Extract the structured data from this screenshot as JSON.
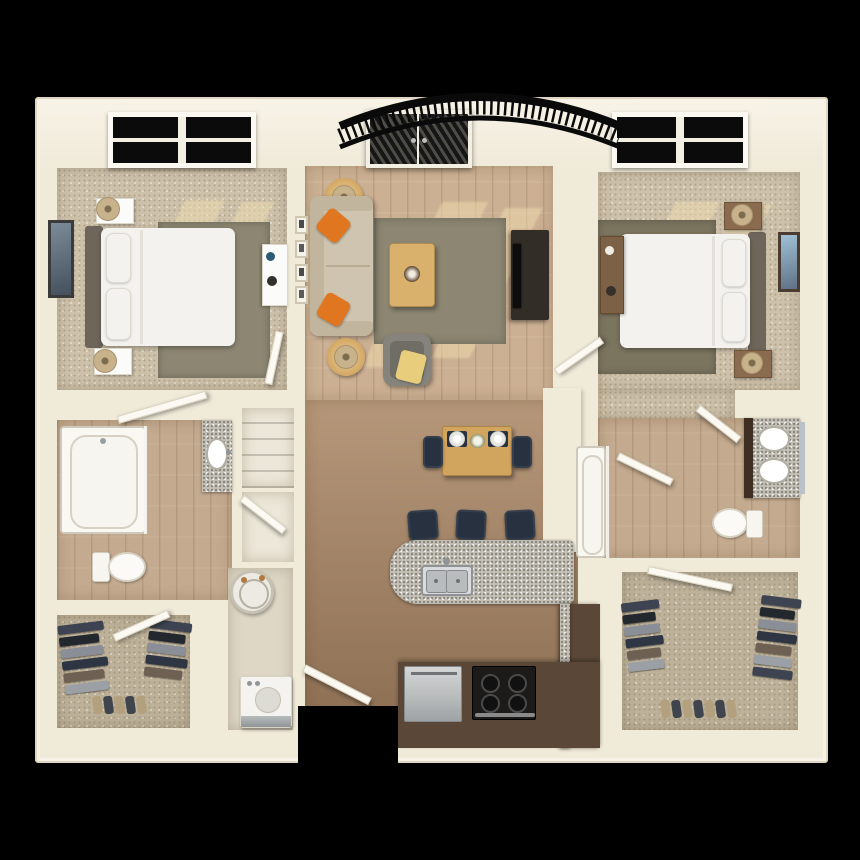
{
  "image": {
    "type": "3d-floor-plan",
    "description": "Top-down 3D rendered floor plan of a two-bedroom, two-bathroom apartment with living room, open kitchen and dining area, laundry room, two walk-in closets and an arched balcony railing at the top. No text labels are rendered.",
    "width_px": 860,
    "height_px": 860,
    "background": "#000000"
  },
  "summary": {
    "bedrooms": 2,
    "bathrooms": 2,
    "walk_in_closets": 2,
    "balcony": "arched black wrought-iron railing behind french doors",
    "entry": "open white entry door at bottom center"
  },
  "palette": {
    "bg": "#000000",
    "wall": "#f0ead9",
    "wallHi": "#f8f3e7",
    "carpet": "#cdc1aa",
    "carpetDark": "#bdb199",
    "woodTop": "#ccb093",
    "woodMid": "#b6977a",
    "woodBottom": "#8a6c51",
    "bathWood": "#c4aa8e",
    "rugOlive": "#8c8672",
    "rugDark": "#7b745f",
    "sofa": "#cfc4af",
    "sofaDark": "#c2b59e",
    "orange": "#e0761f",
    "tableWood": "#d2a55f",
    "coffee": "#d9b06c",
    "tvDark": "#332d28",
    "screen": "#0d0d0d",
    "chairGray": "#85837c",
    "chairGrayDark": "#6f6d64",
    "throwYellow": "#e7cd7c",
    "navy": "#27313f",
    "granite": "#c2beb4",
    "cabinetBrown": "#5a4737",
    "stainless": "#b9bcbd",
    "rangeBlack": "#1d1b19",
    "bedWhite": "#f3f2ee",
    "headboard": "#6e665b",
    "nightWhite": "#fbfbf9",
    "woodBrown": "#8a6b4f",
    "lampTan": "#c7b28c",
    "lampRing": "#a8946e",
    "artBlue": "#5f7186",
    "glassDark": "#0b0b0b",
    "doorWhite": "#fbf9f2",
    "doorEdge": "#d8d2c0",
    "sun": "#f0ddb0",
    "shadowOlive": "#8d8568",
    "fixtureBorder": "#cfc9bb",
    "tubWhite": "#f6f5f0",
    "linenFloor": "#ece7d8",
    "laundryFloor": "#ded7c5",
    "heaterWhite": "#eceae3",
    "copper": "#b0793f",
    "shoeTan": "#b3a07e",
    "shoeDark": "#3f444d",
    "garment1": "#3d4350",
    "garment2": "#23272e",
    "garment3": "#8a8e96",
    "garment4": "#2e3644",
    "garment5": "#6e6154",
    "garment6": "#9aa0a6",
    "railing": "#0a0a0a",
    "mirror": "#b9c2c6"
  },
  "rooms": [
    {
      "id": "bedroom-1",
      "position": "top-left",
      "floor": "carpet",
      "features": [
        "four-pane window",
        "sunlight patches on carpet"
      ],
      "furniture": [
        "double bed with dark headboard on left wall",
        "two white nightstands with tan table lamps",
        "dark olive area rug",
        "framed wall art on left wall",
        "small white desk on right wall"
      ]
    },
    {
      "id": "living-room",
      "position": "top-center",
      "floor": "hardwood",
      "features": [
        "french doors with dark glass to balcony",
        "arched black balcony railing",
        "four small gallery frames on left wall",
        "sunlight patches"
      ],
      "furniture": [
        "beige sofa with two orange accent pillows",
        "two round wood end tables with lamps",
        "wood coffee table with decor",
        "olive area rug",
        "dark media console with flat tv",
        "gray armchair with yellow throw"
      ]
    },
    {
      "id": "bedroom-2",
      "position": "top-right",
      "floor": "carpet",
      "features": [
        "four-pane window",
        "sunlight patches"
      ],
      "furniture": [
        "double bed with headboard on right wall",
        "two brown nightstands with lamps",
        "dark olive area rug",
        "brown dresser on left wall",
        "framed blue wall art on right wall"
      ]
    },
    {
      "id": "bathroom-1",
      "position": "mid-left",
      "floor": "hardwood",
      "fixtures": [
        "bathtub with glass panel",
        "toilet",
        "granite vanity with oval sink"
      ]
    },
    {
      "id": "linen-closet",
      "position": "center-left",
      "floor": "light",
      "contents": [
        "shelving"
      ]
    },
    {
      "id": "laundry-room",
      "position": "center-left-lower",
      "floor": "light",
      "fixtures": [
        "round water heater with copper pipes",
        "washer with stainless front"
      ]
    },
    {
      "id": "walk-in-closet-1",
      "position": "bottom-left",
      "floor": "carpet",
      "contents": [
        "hanging clothes on left rail",
        "hanging clothes on right rail",
        "row of shoes"
      ]
    },
    {
      "id": "dining-area",
      "position": "center",
      "floor": "hardwood",
      "furniture": [
        "wood dining table",
        "two navy chairs",
        "two place settings with white plates on navy mats",
        "flower centerpiece"
      ]
    },
    {
      "id": "kitchen",
      "position": "bottom-center",
      "floor": "hardwood",
      "fixtures": [
        "granite breakfast island with double stainless sink",
        "three navy bar stools",
        "stainless dishwasher",
        "black range with four burners",
        "dark brown base cabinets"
      ]
    },
    {
      "id": "bathroom-2",
      "position": "mid-right",
      "floor": "hardwood",
      "fixtures": [
        "bathtub with glass panel",
        "toilet",
        "granite double vanity with two oval sinks and mirror"
      ]
    },
    {
      "id": "walk-in-closet-2",
      "position": "bottom-right",
      "floor": "carpet",
      "contents": [
        "hanging clothes on left rail",
        "hanging clothes on right rail",
        "row of shoes"
      ]
    },
    {
      "id": "entry",
      "position": "bottom-center",
      "features": [
        "door cutout in bottom wall",
        "open white entry door"
      ]
    }
  ],
  "doors": [
    "entry-door",
    "bedroom-1-door",
    "bathroom-1-door",
    "linen-closet-door",
    "closet-1-door",
    "bedroom-2-door",
    "bathroom-2-door",
    "hall-2-door",
    "closet-2-door",
    "french-doors"
  ],
  "windows": [
    "bedroom-1-window",
    "bedroom-2-window"
  ]
}
